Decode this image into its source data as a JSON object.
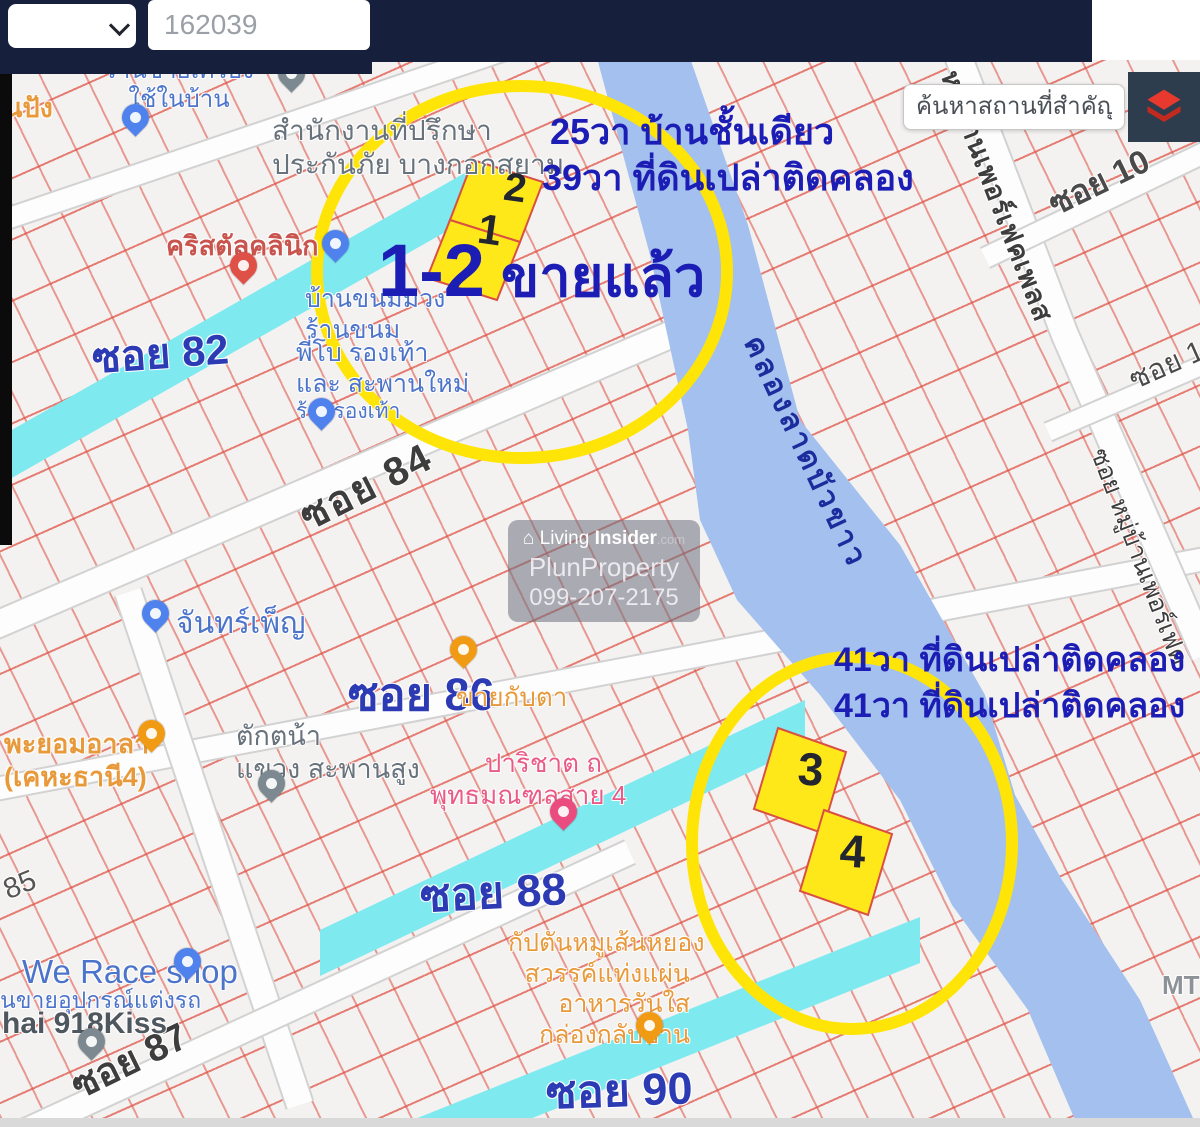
{
  "header": {
    "dropdown": {
      "label": ""
    },
    "id_input": {
      "value": "162039"
    },
    "map_search": {
      "placeholder": "ค้นหาสถานที่สำคัญ"
    },
    "layers_button": {
      "icon": "layers-icon"
    }
  },
  "annotations": {
    "top_line1": "25วา บ้านชั้นเดียว",
    "top_line2": "39วา ที่ดินเปล่าติดคลอง",
    "sold_numbers": "1-2",
    "sold_text": "ขายแล้ว",
    "right_line1": "41วา ที่ดินเปล่าติดคลอง",
    "right_line2": "41วา ที่ดินเปล่าติดคลอง",
    "plot1": "1",
    "plot2": "2",
    "plot3": "3",
    "plot4": "4"
  },
  "streets": {
    "soi82": "ซอย 82",
    "soi84": "ซอย 84",
    "soi85": "85",
    "soi86": "ซอย 86",
    "soi87": "ซอย 87",
    "soi88": "ซอย 88",
    "soi90": "ซอย 90",
    "soi10": "ซอย 10",
    "soi1": "ซอย 1",
    "perfect_place": "หมู่บ้านเพอร์เฟคเพลส",
    "soi_perfect": "ซอย หมู่บ้านเพอร์เฟค",
    "mt": "MT"
  },
  "canal": {
    "name": "คลองลาดบัวขาว"
  },
  "pois": {
    "bakery": {
      "line1": "นปัง"
    },
    "household": {
      "line1": "ร้านขายเครื่อง",
      "line2": "ใช้ในบ้าน"
    },
    "office": {
      "line1": "สำนักงานที่ปรึกษา",
      "line2": "ประกันภัย บางกอกสยาม"
    },
    "clinic": {
      "line1": "คริสตัลคลินิก"
    },
    "dessert": {
      "line1": "บ้านขนมมวง",
      "line2": "ร้านขนม"
    },
    "shoes": {
      "line1": "พี่โบ รองเท้า",
      "line2": "และ สะพานใหม่",
      "line3": "ร้านรองเท้า"
    },
    "chanpen": {
      "line1": "จันทร์เพ็ญ"
    },
    "kabta": {
      "line1": "ขายกับตา"
    },
    "takton": {
      "line1": "ตักตน้า",
      "line2": "แขวง สะพานสูง"
    },
    "phayom": {
      "line1": "พะยอมอาลา",
      "line2": "(เคหะธานี4)"
    },
    "parichat": {
      "line1": "ปาริชาต ถ",
      "line2": "พุทธมณฑลสาย 4"
    },
    "captain": {
      "line1": "กัปตันหมูเส้นหยอง",
      "line2": "สวรรค์แท่งแผ่น",
      "line3": "อาหารวันใส",
      "line4": "กล่องกลับบ้าน"
    },
    "werace": {
      "line1": "We Race shop",
      "line2": "นขายอุปกรณ์แต่งรถ",
      "line3": "hai 918Kiss"
    }
  },
  "watermark": {
    "icon": "⌂",
    "brand_prefix": "Living ",
    "brand_bold": "Insider",
    "brand_suffix": ".com",
    "line2": "PlunProperty",
    "line3": "099-207-2175"
  },
  "colors": {
    "header_navy": "#16203c",
    "layers_btn_bg": "#2e3d4e",
    "layers_icon_red": "#e8392e",
    "grid_red": "#df5043",
    "road_cyan": "#7ee9ef",
    "canal_blue": "#a3c0ee",
    "plot_yellow": "#ffe81a",
    "circle_yellow": "#ffe408",
    "annotation_blue": "#1b1db5",
    "street_blue": "#2c3ab4"
  }
}
